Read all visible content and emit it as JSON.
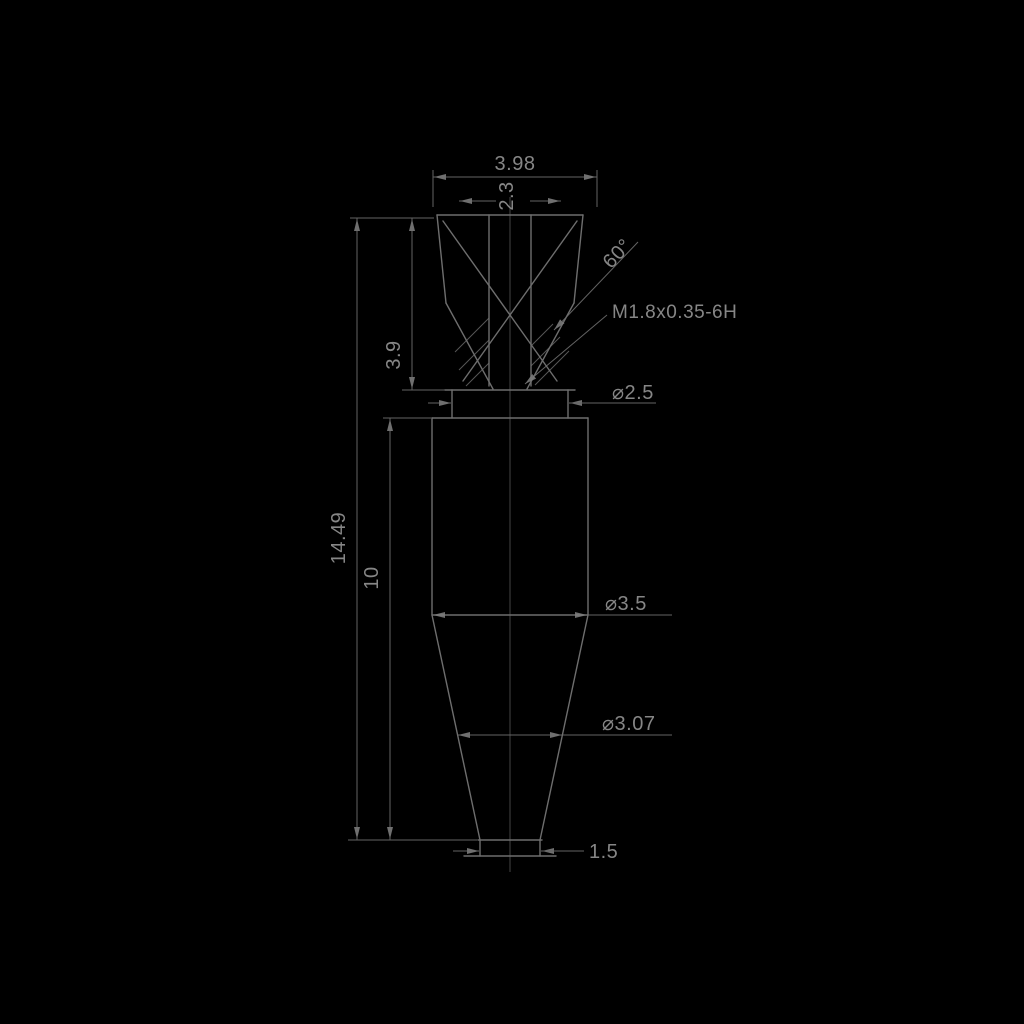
{
  "drawing": {
    "type": "technical-dimension-drawing",
    "background_color": "#000000",
    "line_color": "#6e6e6e",
    "text_color": "#868686",
    "labels": {
      "width_top": "3.98",
      "width_inner": "2.3",
      "cone_angle": "60°",
      "thread_callout": "M1.8x0.35-6H",
      "head_height": "3.9",
      "neck_diameter": "⌀2.5",
      "total_length": "14.49",
      "body_length": "10",
      "body_diameter": "⌀3.5",
      "cone_diameter": "⌀3.07",
      "tip_width": "1.5"
    }
  }
}
